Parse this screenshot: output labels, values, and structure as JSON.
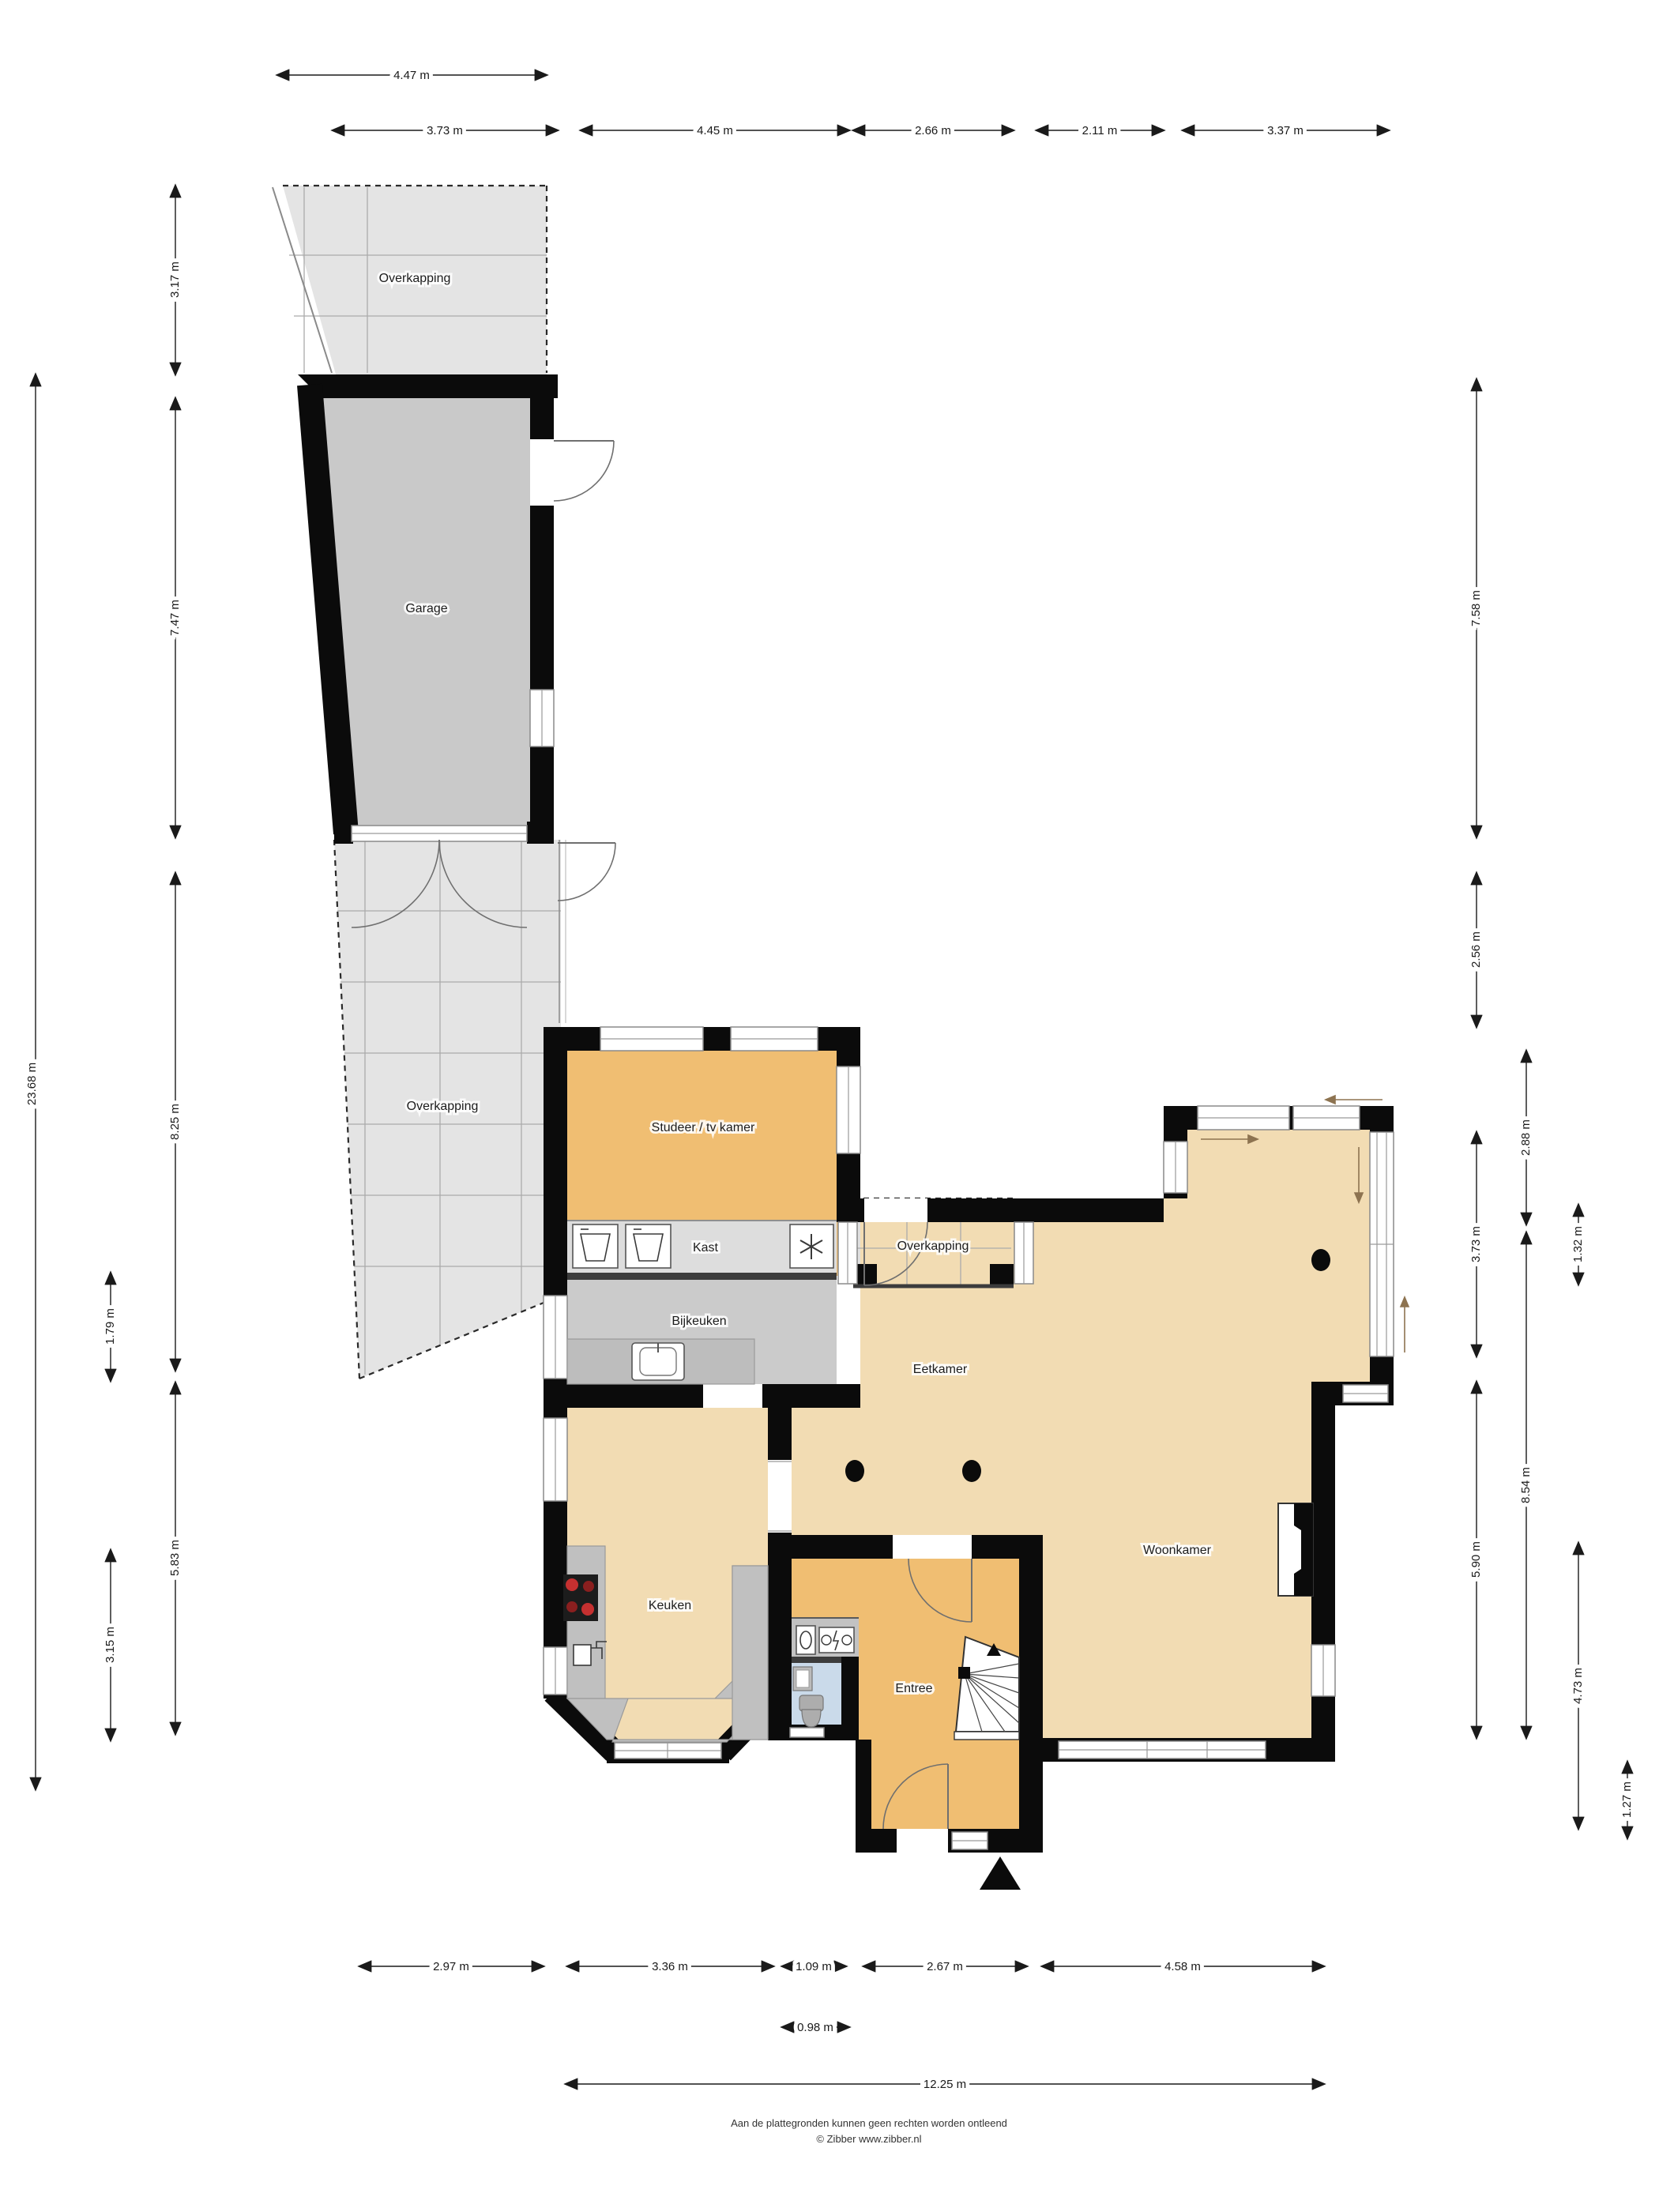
{
  "labels": {
    "overkapping_top": "Overkapping",
    "garage": "Garage",
    "overkapping_strip": "Overkapping",
    "studeer": "Studeer / tv kamer",
    "kast": "Kast",
    "bijkeuken": "Bijkeuken",
    "overkapping_small": "Overkapping",
    "eetkamer": "Eetkamer",
    "keuken": "Keuken",
    "woonkamer": "Woonkamer",
    "entree": "Entree"
  },
  "dims": {
    "top1": [
      {
        "label": "4.47 m",
        "meters": 4.47
      }
    ],
    "top2": [
      {
        "label": "3.73 m",
        "meters": 3.73
      },
      {
        "label": "4.45 m",
        "meters": 4.45
      },
      {
        "label": "2.66 m",
        "meters": 2.66
      },
      {
        "label": "2.11 m",
        "meters": 2.11
      },
      {
        "label": "3.37 m",
        "meters": 3.37
      }
    ],
    "left_outer": [
      {
        "label": "23.68 m",
        "meters": 23.68
      }
    ],
    "left_mid": [
      {
        "label": "1.79 m",
        "meters": 1.79
      },
      {
        "label": "3.15 m",
        "meters": 3.15
      }
    ],
    "left_inner": [
      {
        "label": "3.17 m",
        "meters": 3.17
      },
      {
        "label": "7.47 m",
        "meters": 7.47
      },
      {
        "label": "8.25 m",
        "meters": 8.25
      },
      {
        "label": "5.83 m",
        "meters": 5.83
      }
    ],
    "right_col1": [
      {
        "label": "7.58 m",
        "meters": 7.58
      },
      {
        "label": "2.56 m",
        "meters": 2.56
      },
      {
        "label": "3.73 m",
        "meters": 3.73
      },
      {
        "label": "5.90 m",
        "meters": 5.9
      }
    ],
    "right_col2": [
      {
        "label": "2.88 m",
        "meters": 2.88
      },
      {
        "label": "8.54 m",
        "meters": 8.54
      }
    ],
    "right_col3": [
      {
        "label": "1.32 m",
        "meters": 1.32
      },
      {
        "label": "4.73 m",
        "meters": 4.73
      }
    ],
    "right_col4": [
      {
        "label": "1.27 m",
        "meters": 1.27
      }
    ],
    "bottom_row": [
      {
        "label": "2.97 m",
        "meters": 2.97
      },
      {
        "label": "3.36 m",
        "meters": 3.36
      },
      {
        "label": "1.09 m",
        "meters": 1.09
      },
      {
        "label": "2.67 m",
        "meters": 2.67
      },
      {
        "label": "4.58 m",
        "meters": 4.58
      }
    ],
    "bottom_small": [
      {
        "label": "0.98 m",
        "meters": 0.98
      }
    ],
    "bottom_total": [
      {
        "label": "12.25 m",
        "meters": 12.25
      }
    ]
  },
  "footer": {
    "line1": "Aan de plattegronden kunnen geen rechten worden ontleend",
    "line2": "© Zibber www.zibber.nl"
  },
  "colors": {
    "floor_living": "#F2DCB3",
    "floor_orange": "#F0BE72",
    "garage": "#C9C9C9",
    "overkapping": "#E4E4E4",
    "kast": "#DDDDDD",
    "bijkeuken": "#CBCBCB",
    "counter": "#C0C0C0",
    "toilet_floor": "#CADAEA",
    "wall": "#0B0B0B",
    "burner_red": "#C53030"
  }
}
